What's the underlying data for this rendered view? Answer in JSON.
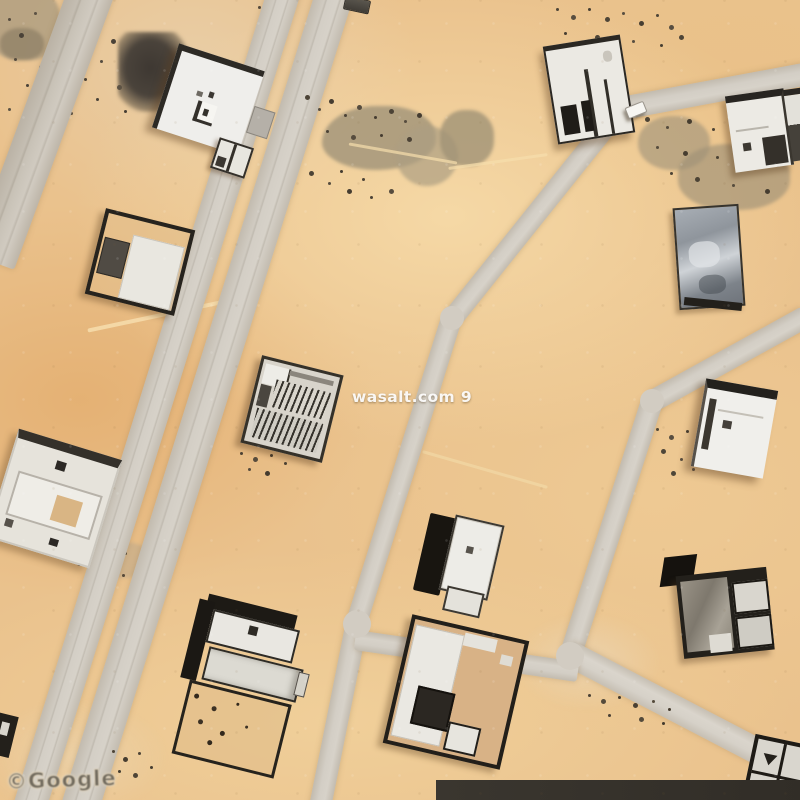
{
  "map": {
    "type": "satellite-imagery",
    "watermark": {
      "brand": "wasalt.com 9"
    },
    "attribution": {
      "provider": "©Google"
    },
    "palette": {
      "sand": "#eac28d",
      "road": "#cfc9c0",
      "building_light": "#efeeea",
      "building_dark": "#26231f",
      "platform_gray": "#99a0a8",
      "courtyard_tan": "#d8b286",
      "bottom_band": "#36322b"
    }
  }
}
